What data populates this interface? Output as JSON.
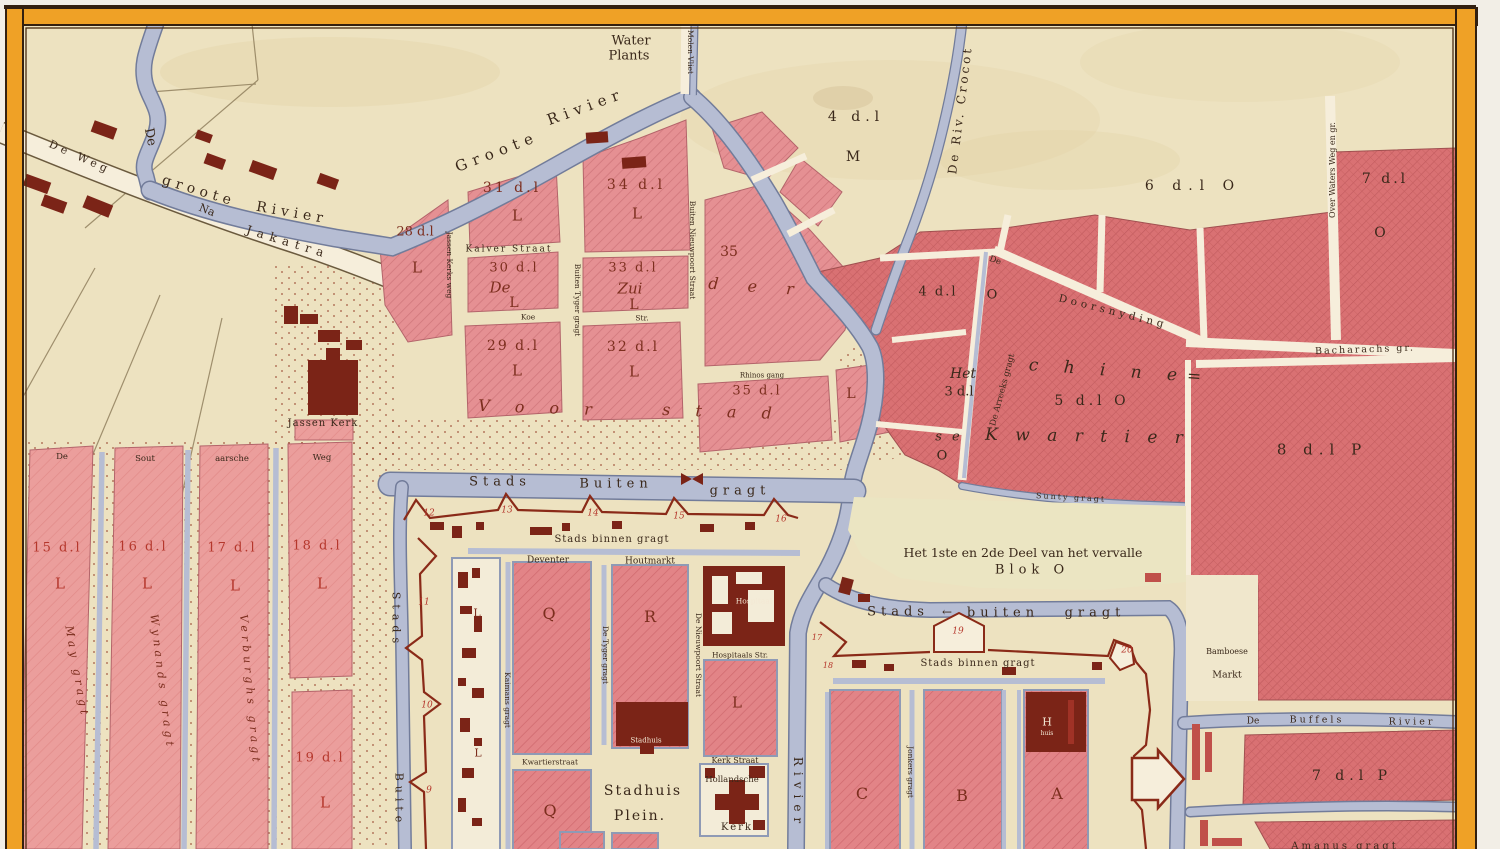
{
  "palette": {
    "paper": "#f2eee6",
    "mapCream": "#ede2c0",
    "cream2": "#f6eedb",
    "water": "#b6bdd3",
    "waterEdge": "#727c9a",
    "borderOrange": "#efa126",
    "borderDark": "#33200f",
    "inkDark": "#3a281a",
    "inkMaroon": "#7c2e1e",
    "inkRed": "#b5372c",
    "building": "#7b2417",
    "wall": "#8a2a18",
    "blockPink": "#e59093",
    "blockEast": "#d97173"
  },
  "map": {
    "labels": [
      {
        "t": "Water",
        "x": 631,
        "y": 41,
        "s": 13,
        "c": "dk"
      },
      {
        "t": "Plants",
        "x": 629,
        "y": 56,
        "s": 13,
        "c": "dk"
      },
      {
        "t": "Molen Vliet",
        "x": 690,
        "y": 52,
        "r": 90,
        "s": 7.5,
        "c": "dk"
      },
      {
        "t": "Groote",
        "x": 497,
        "y": 152,
        "r": -21,
        "s": 15,
        "c": "dks",
        "ls": 6
      },
      {
        "t": "Rivier",
        "x": 586,
        "y": 107,
        "r": -20,
        "s": 15,
        "c": "dks",
        "ls": 6
      },
      {
        "t": "De",
        "x": 150,
        "y": 137,
        "r": 78,
        "s": 13,
        "c": "dks"
      },
      {
        "t": "groote",
        "x": 199,
        "y": 191,
        "r": 17,
        "s": 14,
        "c": "dks",
        "ls": 5
      },
      {
        "t": "Rivier",
        "x": 292,
        "y": 213,
        "r": 10,
        "s": 14,
        "c": "dks",
        "ls": 5
      },
      {
        "t": "De Weg",
        "x": 80,
        "y": 157,
        "r": 24,
        "s": 11,
        "c": "dks",
        "ls": 4
      },
      {
        "t": "Na",
        "x": 207,
        "y": 210,
        "r": 22,
        "s": 11,
        "c": "dks"
      },
      {
        "t": "Jakatra",
        "x": 288,
        "y": 242,
        "r": 17,
        "s": 12,
        "c": "dks",
        "ls": 6
      },
      {
        "t": "De Riv. Crocot",
        "x": 960,
        "y": 110,
        "r": -83,
        "s": 12,
        "c": "dks",
        "ls": 3
      },
      {
        "t": "4 d.l",
        "x": 856,
        "y": 117,
        "s": 14,
        "c": "dk",
        "ls": 5
      },
      {
        "t": "M",
        "x": 853,
        "y": 157,
        "s": 14,
        "c": "dk"
      },
      {
        "t": "6 d.l O",
        "x": 1193,
        "y": 186,
        "s": 14,
        "c": "dk",
        "ls": 7
      },
      {
        "t": "7 d.l",
        "x": 1385,
        "y": 179,
        "s": 14,
        "c": "dk",
        "ls": 3
      },
      {
        "t": "O",
        "x": 1380,
        "y": 233,
        "s": 14,
        "c": "dk"
      },
      {
        "t": "Over Waters Weg en gr.",
        "x": 1333,
        "y": 170,
        "r": -90,
        "s": 8,
        "c": "dk"
      },
      {
        "t": "Bacharachs gr.",
        "x": 1365,
        "y": 350,
        "r": -2,
        "s": 9.5,
        "c": "dks",
        "ls": 2
      },
      {
        "t": "28 d.l",
        "x": 415,
        "y": 232,
        "s": 13,
        "c": "mar"
      },
      {
        "t": "L",
        "x": 417,
        "y": 268,
        "s": 15,
        "c": "mar"
      },
      {
        "t": "Jassen Kerks weg",
        "x": 449,
        "y": 265,
        "r": 90,
        "s": 7.5,
        "c": "dk"
      },
      {
        "t": "31 d.l",
        "x": 512,
        "y": 188,
        "s": 14,
        "c": "mar",
        "ls": 3
      },
      {
        "t": "L",
        "x": 517,
        "y": 216,
        "s": 15,
        "c": "mar"
      },
      {
        "t": "Kalver Straat",
        "x": 509,
        "y": 250,
        "s": 9,
        "c": "dks",
        "ls": 2
      },
      {
        "t": "30 d.l",
        "x": 514,
        "y": 268,
        "s": 13,
        "c": "mar",
        "ls": 2
      },
      {
        "t": "De",
        "x": 500,
        "y": 288,
        "s": 15,
        "c": "mari"
      },
      {
        "t": "L",
        "x": 514,
        "y": 303,
        "s": 14,
        "c": "mar"
      },
      {
        "t": "Koe",
        "x": 528,
        "y": 317,
        "s": 7.5,
        "c": "dk"
      },
      {
        "t": "Str.",
        "x": 642,
        "y": 318,
        "s": 7.5,
        "c": "dk"
      },
      {
        "t": "29 d.l",
        "x": 513,
        "y": 346,
        "s": 14,
        "c": "mar",
        "ls": 2
      },
      {
        "t": "L",
        "x": 517,
        "y": 371,
        "s": 15,
        "c": "mar"
      },
      {
        "t": "Buiten Tyger gragt",
        "x": 577,
        "y": 300,
        "r": 90,
        "s": 7.5,
        "c": "dk"
      },
      {
        "t": "34 d.l",
        "x": 636,
        "y": 185,
        "s": 14,
        "c": "mar",
        "ls": 3
      },
      {
        "t": "L",
        "x": 637,
        "y": 214,
        "s": 15,
        "c": "mar"
      },
      {
        "t": "33 d.l",
        "x": 633,
        "y": 268,
        "s": 13,
        "c": "mar",
        "ls": 2
      },
      {
        "t": "Zui",
        "x": 630,
        "y": 289,
        "s": 15,
        "c": "mari"
      },
      {
        "t": "L",
        "x": 634,
        "y": 305,
        "s": 14,
        "c": "mar"
      },
      {
        "t": "32 d.l",
        "x": 633,
        "y": 347,
        "s": 14,
        "c": "mar",
        "ls": 2
      },
      {
        "t": "L",
        "x": 634,
        "y": 372,
        "s": 15,
        "c": "mar"
      },
      {
        "t": "Buiten Nieuwpoort Straat",
        "x": 692,
        "y": 250,
        "r": 90,
        "s": 7.5,
        "c": "dk"
      },
      {
        "t": "35",
        "x": 729,
        "y": 252,
        "s": 14,
        "c": "mar"
      },
      {
        "t": "d e r",
        "x": 757,
        "y": 287,
        "r": 4,
        "s": 16,
        "c": "mari",
        "ls": 12
      },
      {
        "t": "Rhinos gang",
        "x": 762,
        "y": 376,
        "s": 7,
        "c": "dk"
      },
      {
        "t": "35 d.l",
        "x": 757,
        "y": 391,
        "s": 13,
        "c": "mar",
        "ls": 2
      },
      {
        "t": "V o o r",
        "x": 540,
        "y": 408,
        "r": 2,
        "s": 16,
        "c": "mari",
        "ls": 10
      },
      {
        "t": "s t a d",
        "x": 722,
        "y": 412,
        "r": 2,
        "s": 16,
        "c": "mari",
        "ls": 10
      },
      {
        "t": "L",
        "x": 851,
        "y": 394,
        "s": 14,
        "c": "mar"
      },
      {
        "t": "4 d.l",
        "x": 938,
        "y": 292,
        "s": 13,
        "c": "dk",
        "ls": 2
      },
      {
        "t": "O",
        "x": 992,
        "y": 295,
        "s": 13,
        "c": "dk"
      },
      {
        "t": "De Arreeks gragt",
        "x": 1003,
        "y": 390,
        "r": -75,
        "s": 8.5,
        "c": "dk"
      },
      {
        "t": "De",
        "x": 995,
        "y": 261,
        "r": 20,
        "s": 8.5,
        "c": "dk"
      },
      {
        "t": "Doorsnyding",
        "x": 1113,
        "y": 312,
        "r": 14,
        "s": 10.5,
        "c": "dks",
        "ls": 4
      },
      {
        "t": "Het",
        "x": 963,
        "y": 374,
        "s": 14,
        "c": "dki"
      },
      {
        "t": "3 d.l",
        "x": 959,
        "y": 392,
        "s": 13,
        "c": "dk"
      },
      {
        "t": "s e",
        "x": 949,
        "y": 437,
        "s": 13,
        "c": "dki",
        "ls": 3
      },
      {
        "t": "O",
        "x": 942,
        "y": 456,
        "s": 13,
        "c": "dk"
      },
      {
        "t": "c h i n e=",
        "x": 1120,
        "y": 372,
        "r": 4,
        "s": 17,
        "c": "dki",
        "ls": 10
      },
      {
        "t": "5 d.l O",
        "x": 1092,
        "y": 401,
        "s": 14,
        "c": "dk",
        "ls": 4
      },
      {
        "t": "K w a r t i e r",
        "x": 1087,
        "y": 437,
        "r": 1,
        "s": 17,
        "c": "dki",
        "ls": 6
      },
      {
        "t": "Sunty gragt",
        "x": 1071,
        "y": 498,
        "r": 3,
        "s": 8,
        "c": "dk",
        "ls": 2
      },
      {
        "t": "Het 1ste en 2de Deel van het vervalle",
        "x": 1023,
        "y": 553,
        "s": 12.5,
        "c": "dk"
      },
      {
        "t": "Blok O",
        "x": 1032,
        "y": 570,
        "s": 13,
        "c": "dk",
        "ls": 5
      },
      {
        "t": "Stads",
        "x": 500,
        "y": 482,
        "s": 13,
        "c": "dks",
        "ls": 5
      },
      {
        "t": "Buiten",
        "x": 616,
        "y": 484,
        "s": 13,
        "c": "dks",
        "ls": 5
      },
      {
        "t": "gragt",
        "x": 740,
        "y": 491,
        "s": 13,
        "c": "dks",
        "ls": 5
      },
      {
        "t": "Stads",
        "x": 898,
        "y": 612,
        "s": 13,
        "c": "dks",
        "ls": 5
      },
      {
        "t": "←",
        "x": 947,
        "y": 612,
        "s": 12,
        "c": "dk"
      },
      {
        "t": "buiten",
        "x": 1003,
        "y": 613,
        "s": 13,
        "c": "dks",
        "ls": 5
      },
      {
        "t": "gragt",
        "x": 1095,
        "y": 613,
        "s": 13,
        "c": "dks",
        "ls": 5
      },
      {
        "t": "Stads binnen gragt",
        "x": 612,
        "y": 540,
        "s": 10,
        "c": "dks",
        "ls": 1
      },
      {
        "t": "Stads binnen gragt",
        "x": 978,
        "y": 664,
        "s": 10,
        "c": "dks",
        "ls": 1
      },
      {
        "t": "Deventer",
        "x": 548,
        "y": 561,
        "s": 9,
        "c": "dk"
      },
      {
        "t": "Houtmarkt",
        "x": 650,
        "y": 562,
        "s": 9,
        "c": "dk"
      },
      {
        "t": "Kaimans gragt",
        "x": 507,
        "y": 700,
        "r": 90,
        "s": 7.5,
        "c": "dk"
      },
      {
        "t": "De Tyger gragt",
        "x": 605,
        "y": 655,
        "r": 90,
        "s": 7.5,
        "c": "dk"
      },
      {
        "t": "De Nieuwpoort Straat",
        "x": 698,
        "y": 655,
        "r": 90,
        "s": 7.5,
        "c": "dk"
      },
      {
        "t": "L",
        "x": 477,
        "y": 613,
        "s": 11,
        "c": "mar"
      },
      {
        "t": "L",
        "x": 478,
        "y": 753,
        "s": 11,
        "c": "mar"
      },
      {
        "t": "Q",
        "x": 549,
        "y": 614,
        "s": 16,
        "c": "mar"
      },
      {
        "t": "R",
        "x": 650,
        "y": 617,
        "s": 16,
        "c": "mar"
      },
      {
        "t": "Kwartierstraat",
        "x": 550,
        "y": 762,
        "s": 7.5,
        "c": "dk"
      },
      {
        "t": "Q",
        "x": 550,
        "y": 811,
        "s": 16,
        "c": "mar"
      },
      {
        "t": "Stadhuis",
        "x": 646,
        "y": 741,
        "s": 7,
        "c": "wt"
      },
      {
        "t": "Stadhuis",
        "x": 643,
        "y": 791,
        "s": 14,
        "c": "dk",
        "ls": 2
      },
      {
        "t": "Plein.",
        "x": 640,
        "y": 816,
        "s": 14,
        "c": "dk",
        "ls": 2
      },
      {
        "t": "Hospitaal",
        "x": 754,
        "y": 601,
        "s": 7.5,
        "c": "wt"
      },
      {
        "t": "Hospitaals Str.",
        "x": 740,
        "y": 655,
        "s": 7.5,
        "c": "dk"
      },
      {
        "t": "L",
        "x": 737,
        "y": 703,
        "s": 15,
        "c": "mar"
      },
      {
        "t": "Kerk Straat",
        "x": 735,
        "y": 761,
        "s": 8,
        "c": "dk"
      },
      {
        "t": "Hollandsche",
        "x": 732,
        "y": 780,
        "s": 8.5,
        "c": "dk"
      },
      {
        "t": "Kerk",
        "x": 737,
        "y": 828,
        "s": 10,
        "c": "dk",
        "ls": 2
      },
      {
        "t": "Rivier",
        "x": 798,
        "y": 793,
        "r": 90,
        "s": 12,
        "c": "dks",
        "ls": 6
      },
      {
        "t": "C",
        "x": 862,
        "y": 794,
        "s": 16,
        "c": "mar"
      },
      {
        "t": "Jonkers gragt",
        "x": 910,
        "y": 772,
        "r": 90,
        "s": 7.5,
        "c": "dk"
      },
      {
        "t": "B",
        "x": 962,
        "y": 796,
        "s": 16,
        "c": "mar"
      },
      {
        "t": "A",
        "x": 1057,
        "y": 794,
        "s": 16,
        "c": "mar"
      },
      {
        "t": "H",
        "x": 1047,
        "y": 722,
        "s": 11,
        "c": "wt"
      },
      {
        "t": "huis",
        "x": 1047,
        "y": 734,
        "s": 6,
        "c": "wt"
      },
      {
        "t": "12",
        "x": 429,
        "y": 514,
        "s": 9,
        "c": "rdi"
      },
      {
        "t": "13",
        "x": 507,
        "y": 511,
        "s": 9,
        "c": "rdi"
      },
      {
        "t": "14",
        "x": 593,
        "y": 514,
        "s": 9,
        "c": "rdi"
      },
      {
        "t": "15",
        "x": 679,
        "y": 517,
        "s": 9,
        "c": "rdi"
      },
      {
        "t": "16",
        "x": 781,
        "y": 520,
        "s": 9,
        "c": "rdi"
      },
      {
        "t": "11",
        "x": 424,
        "y": 603,
        "s": 9,
        "c": "rdi"
      },
      {
        "t": "10",
        "x": 427,
        "y": 706,
        "s": 9,
        "c": "rdi"
      },
      {
        "t": "9",
        "x": 429,
        "y": 791,
        "s": 9,
        "c": "rdi"
      },
      {
        "t": "17",
        "x": 817,
        "y": 638,
        "s": 8,
        "c": "rdi"
      },
      {
        "t": "18",
        "x": 828,
        "y": 666,
        "s": 8,
        "c": "rdi"
      },
      {
        "t": "19",
        "x": 958,
        "y": 632,
        "s": 9,
        "c": "rdi"
      },
      {
        "t": "20",
        "x": 1127,
        "y": 651,
        "s": 9,
        "c": "rdi"
      },
      {
        "t": "De",
        "x": 62,
        "y": 457,
        "s": 8.5,
        "c": "dk"
      },
      {
        "t": "Sout",
        "x": 145,
        "y": 459,
        "s": 8.5,
        "c": "dk"
      },
      {
        "t": "aarsche",
        "x": 232,
        "y": 459,
        "s": 8.5,
        "c": "dk"
      },
      {
        "t": "Weg",
        "x": 322,
        "y": 458,
        "s": 8.5,
        "c": "dk"
      },
      {
        "t": "15 d.l",
        "x": 57,
        "y": 548,
        "s": 13,
        "c": "rd",
        "ls": 2
      },
      {
        "t": "L",
        "x": 60,
        "y": 584,
        "s": 15,
        "c": "rd"
      },
      {
        "t": "May gragt",
        "x": 77,
        "y": 672,
        "r": 80,
        "s": 11,
        "c": "mari",
        "ls": 4
      },
      {
        "t": "16 d.l",
        "x": 143,
        "y": 547,
        "s": 13,
        "c": "rd",
        "ls": 2
      },
      {
        "t": "L",
        "x": 147,
        "y": 584,
        "s": 15,
        "c": "rd"
      },
      {
        "t": "Wynands gragt",
        "x": 162,
        "y": 682,
        "r": 83,
        "s": 11,
        "c": "mari",
        "ls": 4
      },
      {
        "t": "17 d.l",
        "x": 232,
        "y": 548,
        "s": 13,
        "c": "rd",
        "ls": 2
      },
      {
        "t": "L",
        "x": 235,
        "y": 586,
        "s": 15,
        "c": "rd"
      },
      {
        "t": "Verburghs gragt",
        "x": 250,
        "y": 690,
        "r": 85,
        "s": 11,
        "c": "mari",
        "ls": 4
      },
      {
        "t": "18 d.l",
        "x": 317,
        "y": 546,
        "s": 13,
        "c": "rd",
        "ls": 2
      },
      {
        "t": "L",
        "x": 322,
        "y": 584,
        "s": 15,
        "c": "rd"
      },
      {
        "t": "19 d.l",
        "x": 320,
        "y": 758,
        "s": 13,
        "c": "rd",
        "ls": 2
      },
      {
        "t": "L",
        "x": 325,
        "y": 803,
        "s": 15,
        "c": "rd"
      },
      {
        "t": "Jassen Kerk",
        "x": 323,
        "y": 424,
        "s": 10,
        "c": "dk",
        "ls": 1
      },
      {
        "t": "Stads",
        "x": 396,
        "y": 620,
        "r": 90,
        "s": 11,
        "c": "dks",
        "ls": 5
      },
      {
        "t": "Buite",
        "x": 399,
        "y": 800,
        "r": 90,
        "s": 11,
        "c": "dks",
        "ls": 5
      },
      {
        "t": "Bamboese",
        "x": 1227,
        "y": 652,
        "s": 8,
        "c": "dk"
      },
      {
        "t": "Markt",
        "x": 1227,
        "y": 675,
        "s": 9.5,
        "c": "dk"
      },
      {
        "t": "De",
        "x": 1253,
        "y": 722,
        "s": 9,
        "c": "dks"
      },
      {
        "t": "Buffels",
        "x": 1317,
        "y": 720,
        "s": 9.5,
        "c": "dks",
        "ls": 3
      },
      {
        "t": "Rivier",
        "x": 1412,
        "y": 722,
        "s": 9.5,
        "c": "dks",
        "ls": 3
      },
      {
        "t": "7 d.l P",
        "x": 1352,
        "y": 776,
        "s": 14,
        "c": "dk",
        "ls": 5
      },
      {
        "t": "8 d.l P",
        "x": 1322,
        "y": 450,
        "s": 15,
        "c": "dk",
        "ls": 6
      },
      {
        "t": "Amanus gragt",
        "x": 1345,
        "y": 847,
        "s": 10,
        "c": "dks",
        "ls": 3
      }
    ]
  }
}
